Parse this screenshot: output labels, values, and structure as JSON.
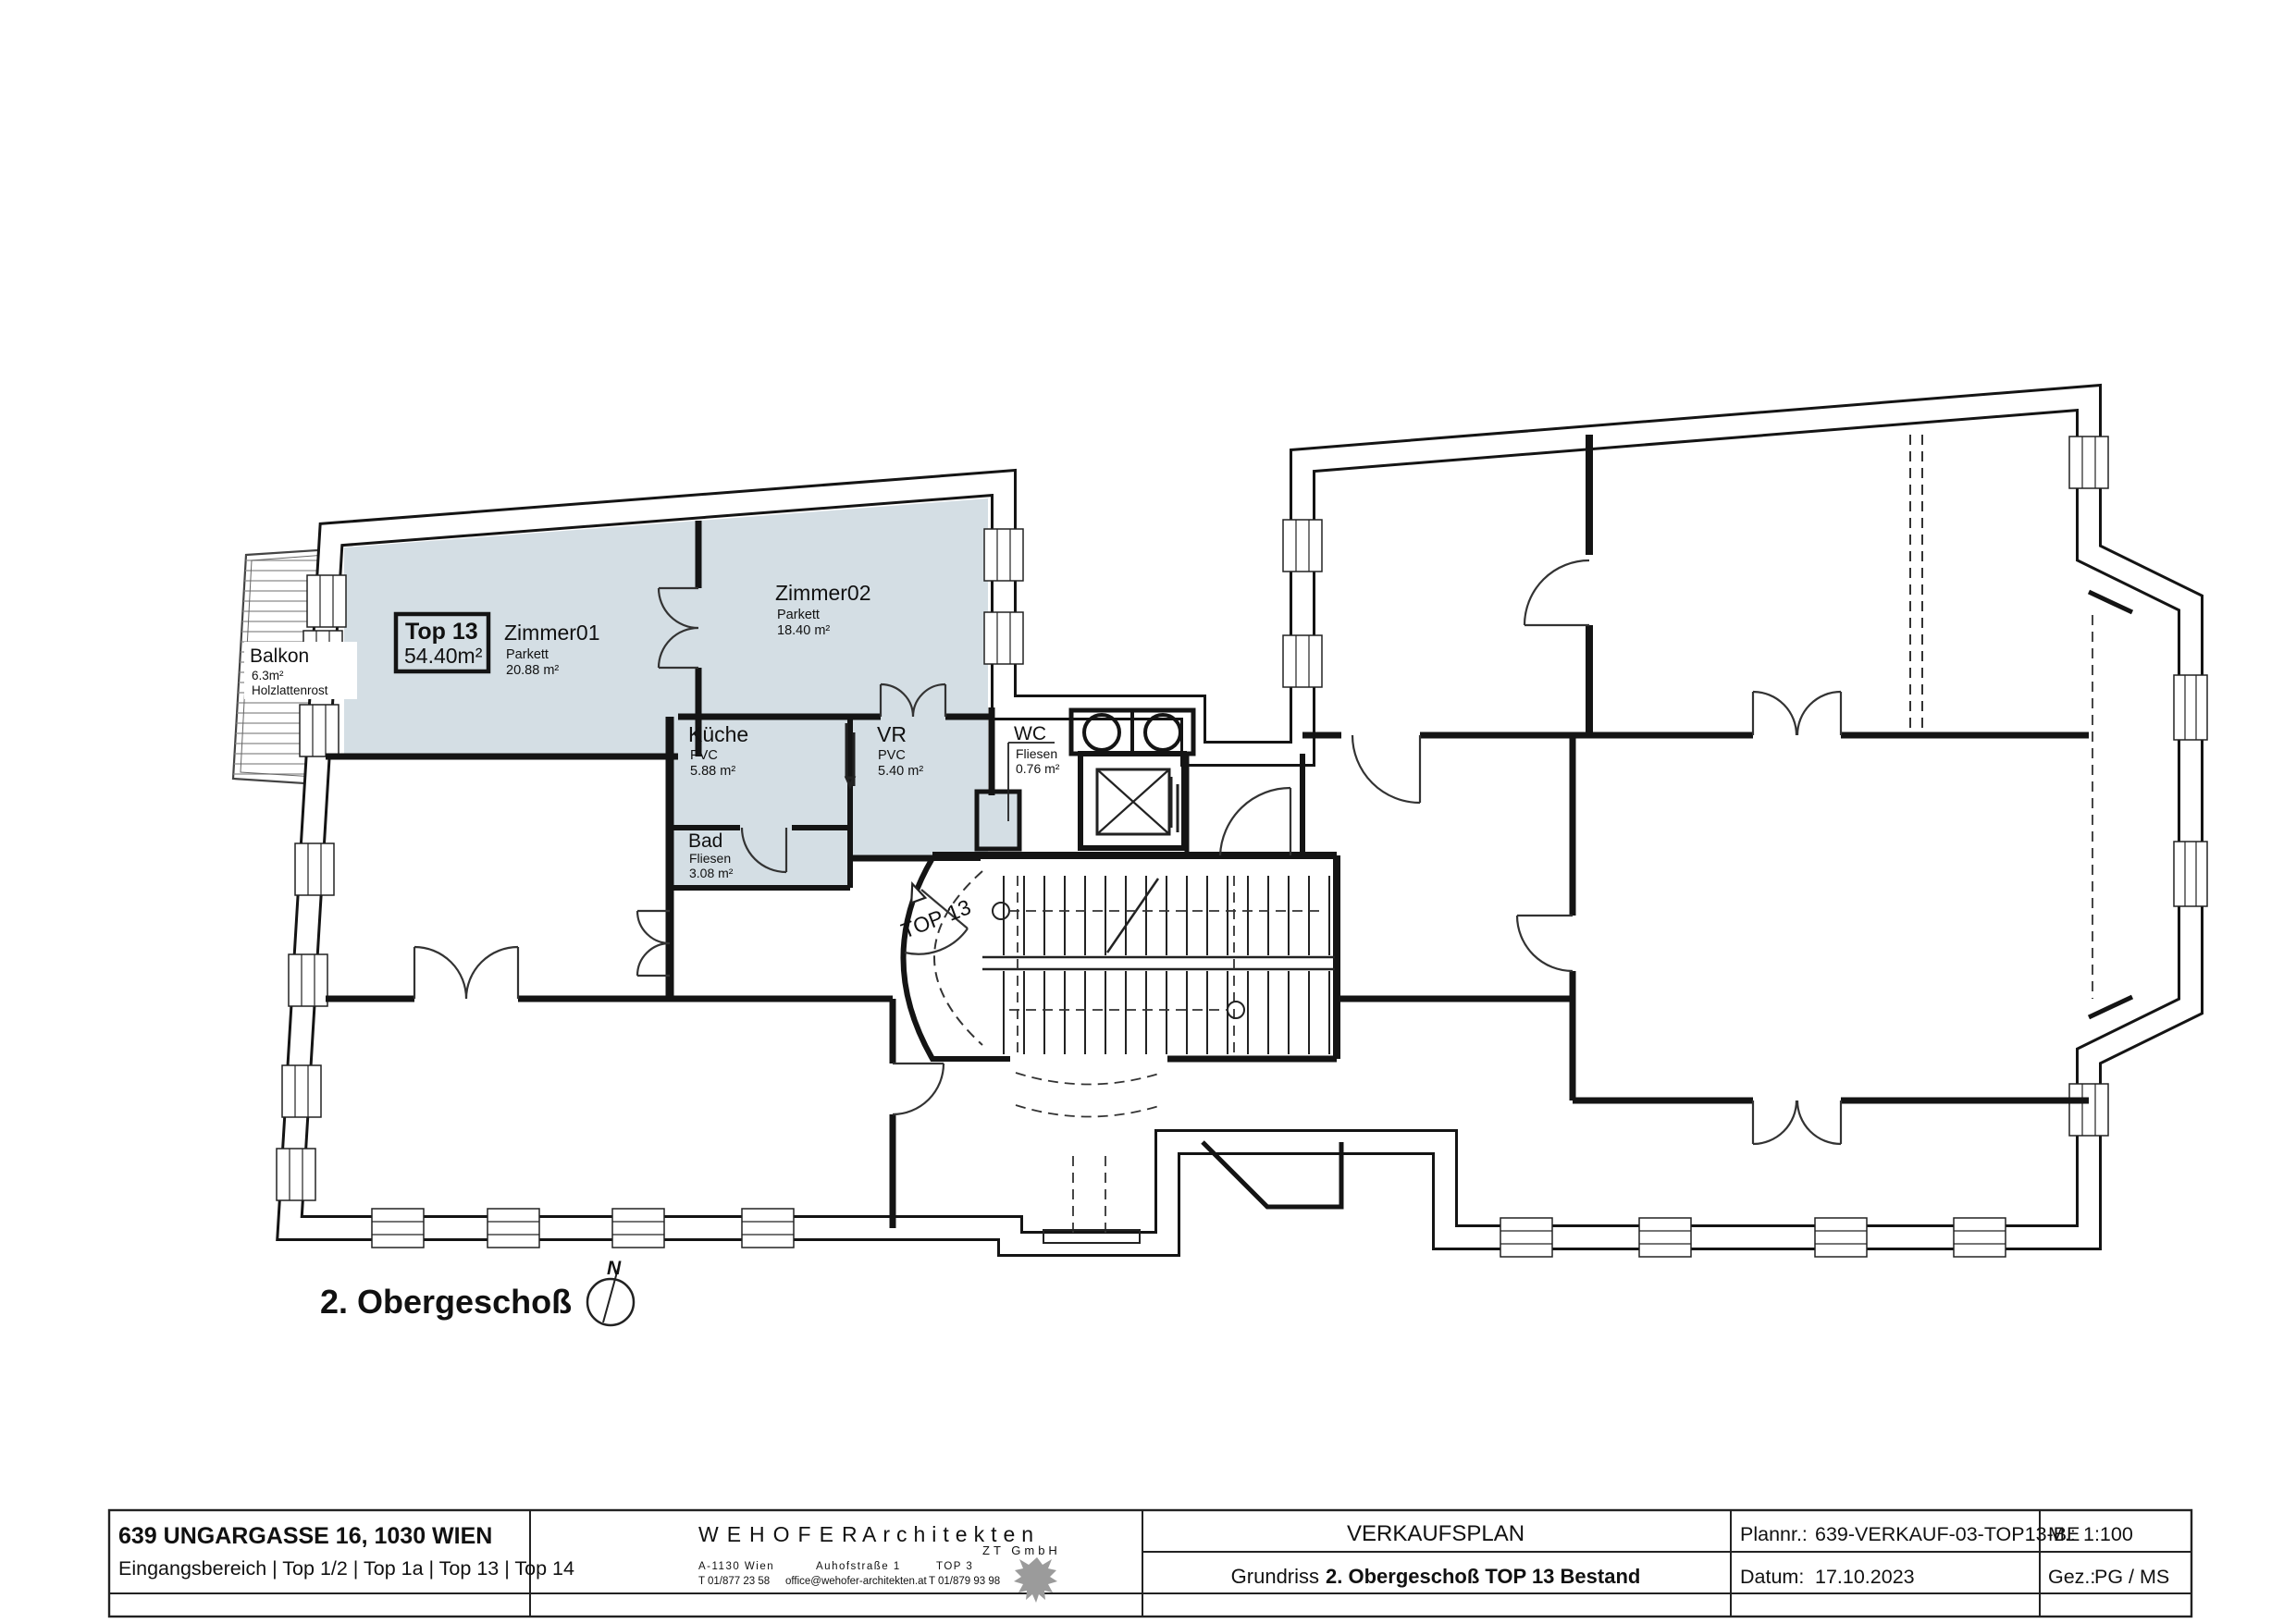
{
  "drawing": {
    "floor_title": "2. Obergeschoß",
    "north_label": "N",
    "top13_badge": {
      "title": "Top 13",
      "area": "54.40m²"
    },
    "entrance_label": "TOP 13",
    "rooms": {
      "zimmer01": {
        "name": "Zimmer01",
        "surface": "Parkett",
        "area": "20.88 m²"
      },
      "zimmer02": {
        "name": "Zimmer02",
        "surface": "Parkett",
        "area": "18.40 m²"
      },
      "kueche": {
        "name": "Küche",
        "surface": "PVC",
        "area": "5.88 m²"
      },
      "vr": {
        "name": "VR",
        "surface": "PVC",
        "area": "5.40 m²"
      },
      "bad": {
        "name": "Bad",
        "surface": "Fliesen",
        "area": "3.08 m²"
      },
      "wc": {
        "name": "WC",
        "surface": "Fliesen",
        "area": "0.76 m²"
      },
      "balkon": {
        "name": "Balkon",
        "area": "6.3m²",
        "surface": "Holzlattenrost"
      }
    }
  },
  "titleblock": {
    "project_address": "639 UNGARGASSE 16, 1030 WIEN",
    "project_units": "Eingangsbereich | Top 1/2 | Top 1a | Top 13 | Top 14",
    "firm_name_black": "WEHOFER",
    "firm_name_orange": "Architekten",
    "firm_suffix": "ZT GmbH",
    "firm_city": "A-1130 Wien",
    "firm_street": "Auhofstraße 1",
    "firm_top": "TOP 3",
    "firm_phone1": "T 01/877 23 58",
    "firm_email": "office@wehofer-architekten.at",
    "firm_phone2": "T 01/879 93 98",
    "plan_type": "VERKAUFSPLAN",
    "plan_title_normal": "Grundriss",
    "plan_title_bold": "2. Obergeschoß TOP 13 Bestand",
    "plannr_label": "Plannr.:",
    "plannr_value": "639-VERKAUF-03-TOP13-BE",
    "datum_label": "Datum:",
    "datum_value": "17.10.2023",
    "massstab_label": "M.:",
    "massstab_value": "1:100",
    "gez_label": "Gez.:",
    "gez_value": "PG / MS"
  },
  "colors": {
    "highlight": "#D4DEE4",
    "accent_orange": "#E8A13C",
    "wall": "#141414",
    "hatch_gray": "#8a8a8a",
    "logo_gray": "#9b9b9b"
  }
}
